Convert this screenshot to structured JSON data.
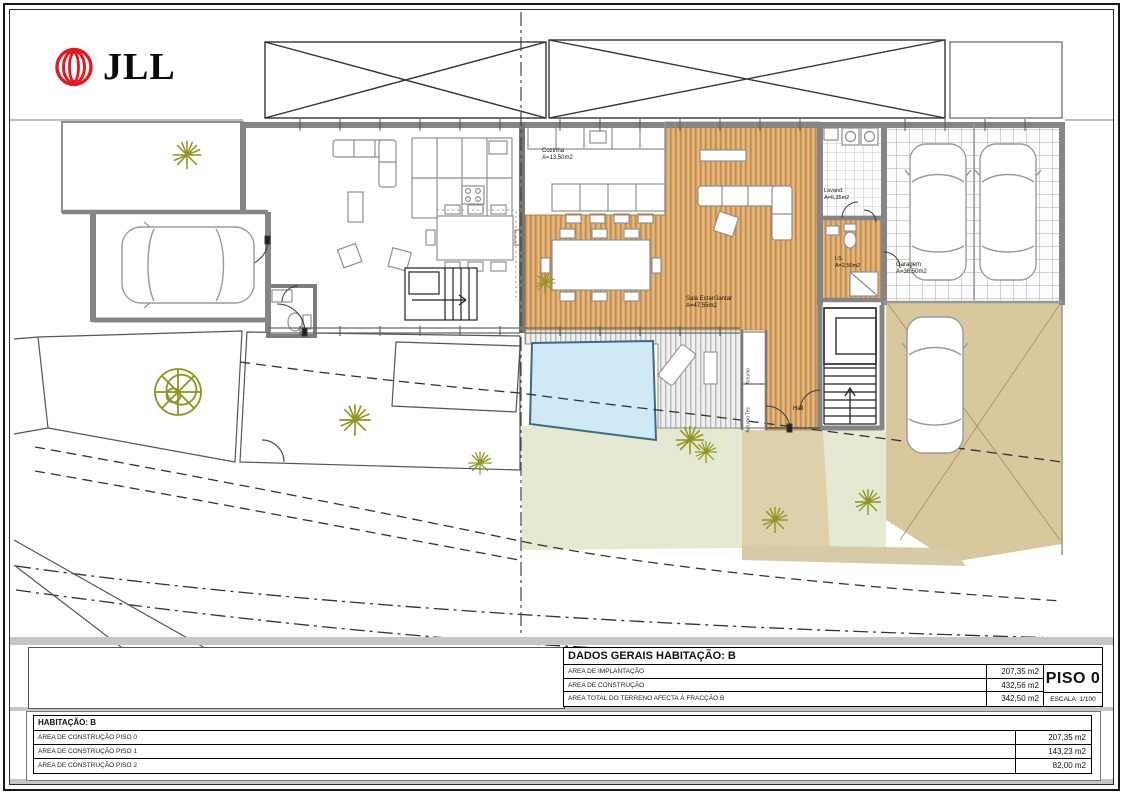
{
  "logo": {
    "text": "JLL"
  },
  "plan": {
    "rooms": [
      {
        "id": "cozinha",
        "label": "Cozinha",
        "area": "A=13,50m2"
      },
      {
        "id": "sala",
        "label": "Sala Estar/Jantar",
        "area": "A=47,55m2"
      },
      {
        "id": "lavandaria",
        "label": "Lavand.",
        "area": "A=6,35m2"
      },
      {
        "id": "is",
        "label": "I.S.",
        "area": "A=2,50m2"
      },
      {
        "id": "garagem",
        "label": "Garagem",
        "area": "A=36,50m2"
      },
      {
        "id": "hall",
        "label": "Hall",
        "area": ""
      },
      {
        "id": "arrumo",
        "label": "Arrumo",
        "area": ""
      },
      {
        "id": "arrumo_tec",
        "label": "Arrumo Tec.",
        "area": ""
      }
    ]
  },
  "dados_gerais": {
    "title": "DADOS GERAIS HABITAÇÃO:  B",
    "rows": [
      {
        "label": "AREA  DE IMPLANTAÇÃO",
        "value": "207,35 m2"
      },
      {
        "label": "AREA DE CONSTRUÇÃO",
        "value": "432,56 m2"
      },
      {
        "label": "AREA  TOTAL DO TERRENO AFECTA À FRACÇÃO B",
        "value": "342,50 m2"
      }
    ],
    "piso": "PISO 0",
    "escala": "ESCALA: 1/100"
  },
  "resumo": {
    "title": "HABITAÇÃO: B",
    "rows": [
      {
        "label": "AREA DE CONSTRUÇÃO  PISO 0",
        "value": "207,35 m2"
      },
      {
        "label": "AREA DE CONSTRUÇÃO  PISO 1",
        "value": "143,23 m2"
      },
      {
        "label": "AREA DE CONSTRUÇÃO  PISO 2",
        "value": "82,00 m2"
      }
    ]
  },
  "colors": {
    "logo_red": "#e01a22",
    "wood_floor": "#dcaa6c",
    "pool": "#cfe9f7",
    "lawn": "#e6e9d2",
    "paving": "#d9c79e",
    "vegetation": "#8f9422",
    "wall_grey": "#858585"
  }
}
